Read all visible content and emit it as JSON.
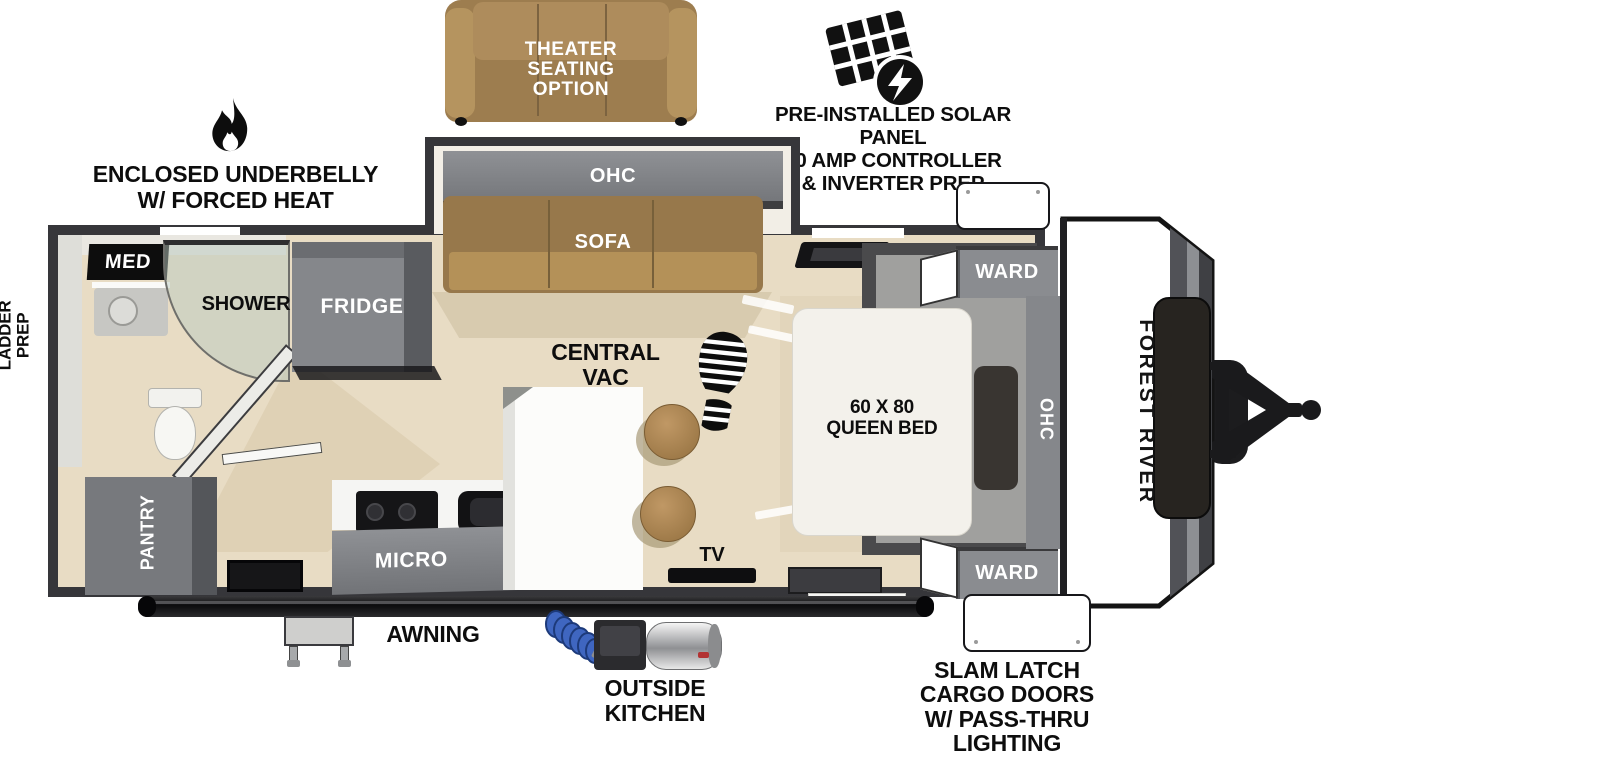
{
  "colors": {
    "wall": "#36363a",
    "floor": "#e8dcc4",
    "cabinet_gray": "#85878b",
    "sofa_brown": "#97784b",
    "bed_white": "#f3f1eb",
    "stool_brown": "#b28a57",
    "hose_blue": "#3f66c0",
    "label_black": "#0d0d0d"
  },
  "callouts": {
    "theater": "THEATER\nSEATING\nOPTION",
    "solar": "PRE-INSTALLED SOLAR PANEL\n30 AMP CONTROLLER\n& INVERTER PREP",
    "underbelly": "ENCLOSED UNDERBELLY\nW/ FORCED HEAT",
    "ladder": "LADDER\nPREP",
    "central_vac": "CENTRAL\nVAC",
    "awning": "AWNING",
    "outside_kitchen": "OUTSIDE\nKITCHEN",
    "slam_latch": "SLAM LATCH\nCARGO DOORS\nW/ PASS-THRU\nLIGHTING"
  },
  "rooms": {
    "med": "MED",
    "shower": "SHOWER",
    "fridge": "FRIDGE",
    "pantry": "PANTRY",
    "slide_ohc": "OHC",
    "sofa": "SOFA",
    "micro": "MICRO",
    "kitchen_ohc": "OHC",
    "tv": "TV",
    "ward_top": "WARD",
    "ward_bottom": "WARD",
    "queen_bed": "60 X 80\nQUEEN BED",
    "bed_ohc": "OHC",
    "brand": "FOREST RIVER"
  }
}
